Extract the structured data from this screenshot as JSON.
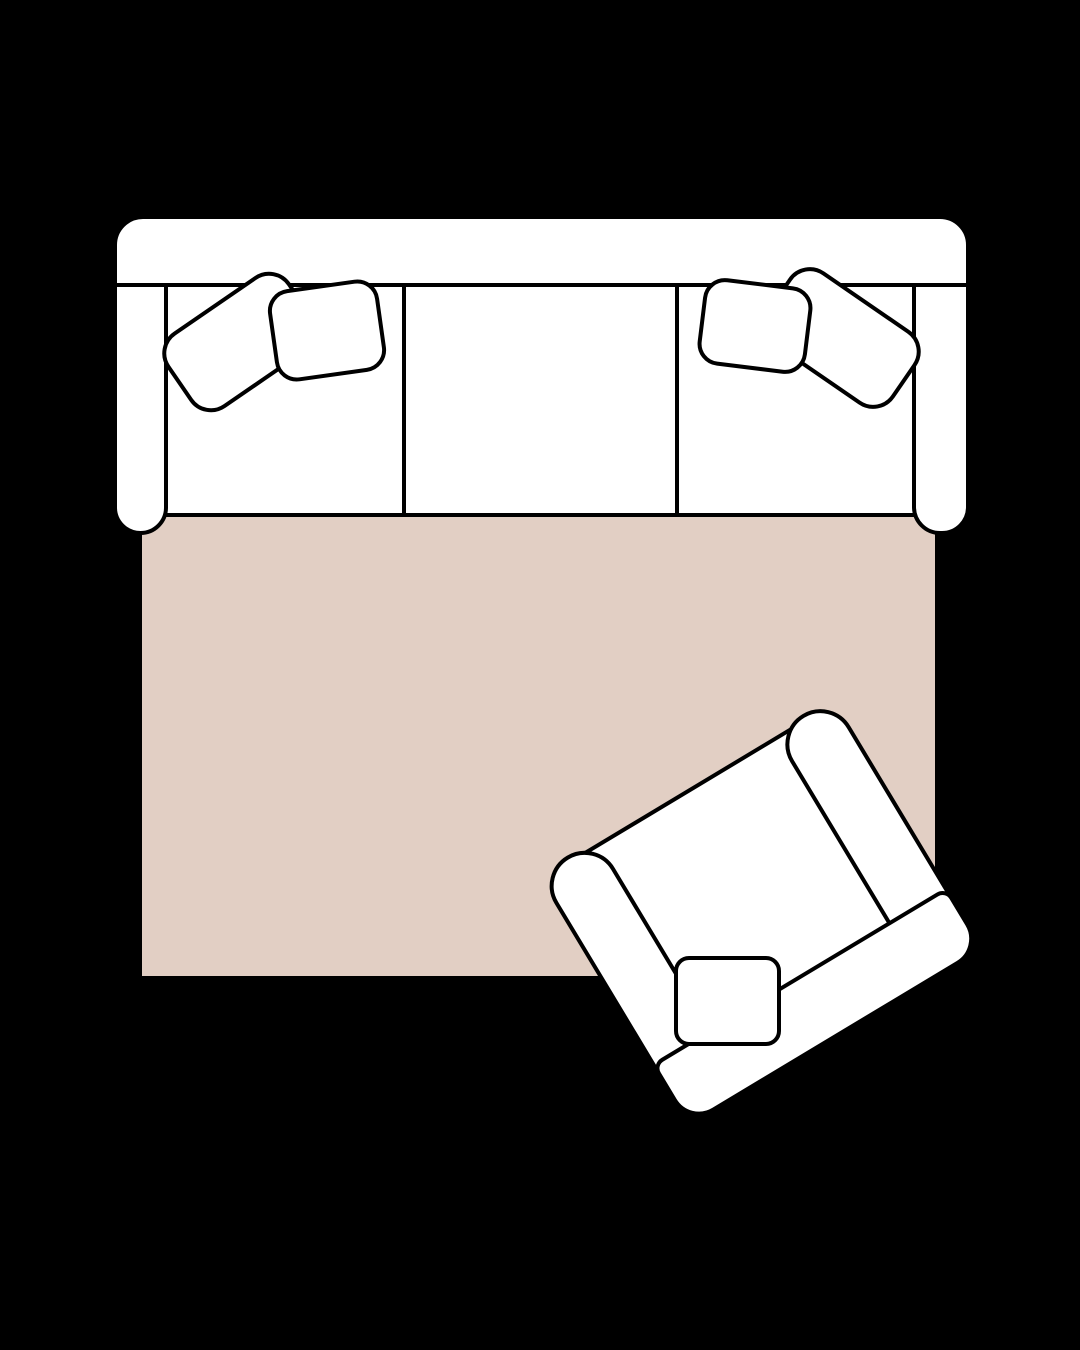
{
  "scene": {
    "title": "Living room furniture layout, top-down view",
    "background": "black canvas, no visible text"
  },
  "colors": {
    "bg": "#000000",
    "fill": "#ffffff",
    "line": "#000000",
    "rug": "#e2cfc4"
  },
  "furniture": {
    "rug": {
      "name": "area rug",
      "shape": "rectangle",
      "fill": "#e2cfc4"
    },
    "sofa": {
      "name": "three-seat sofa",
      "orientation": "horizontal, backrest at top",
      "seat_cushions": 3,
      "armrests": 2,
      "throw_pillows": [
        {
          "name": "left back pillow",
          "shape": "rounded rectangle",
          "rotation_deg": -34.5
        },
        {
          "name": "left front pillow",
          "shape": "rounded square",
          "rotation_deg": -8
        },
        {
          "name": "right front pillow",
          "shape": "rounded square",
          "rotation_deg": 7
        },
        {
          "name": "right back pillow",
          "shape": "rounded rectangle",
          "rotation_deg": 34.5
        }
      ]
    },
    "armchair": {
      "name": "armchair",
      "orientation": "rotated, facing upper-left toward sofa",
      "rotation_deg": -31,
      "armrests": 2,
      "throw_pillows": [
        {
          "name": "seat pillow",
          "shape": "rounded square",
          "rotation_deg": 0
        }
      ]
    }
  }
}
